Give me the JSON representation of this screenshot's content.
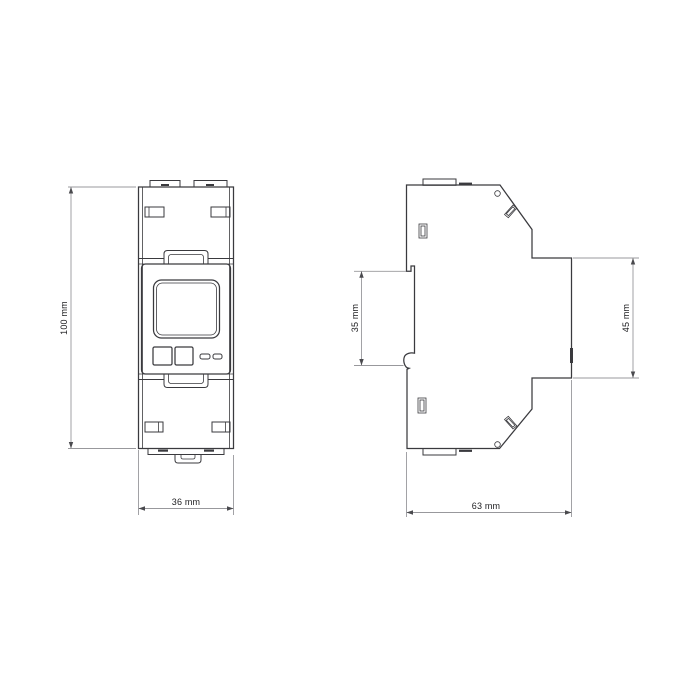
{
  "colors": {
    "line": "#3a3a3e",
    "dim-line": "#98989c",
    "dim-arrow": "#4a4a4e",
    "text": "#1c1c1f",
    "bg": "#ffffff"
  },
  "drawing": {
    "type": "technical-drawing",
    "views": {
      "front": "front-elevation",
      "side": "side-elevation"
    }
  },
  "dimensions": {
    "overall_height": {
      "label": "100 mm",
      "value_mm": 100
    },
    "overall_width": {
      "label": "36 mm",
      "value_mm": 36
    },
    "overall_depth": {
      "label": "63 mm",
      "value_mm": 63
    },
    "front_face_height": {
      "label": "45 mm",
      "value_mm": 45
    },
    "rail_recess_height": {
      "label": "35 mm",
      "value_mm": 35
    }
  }
}
